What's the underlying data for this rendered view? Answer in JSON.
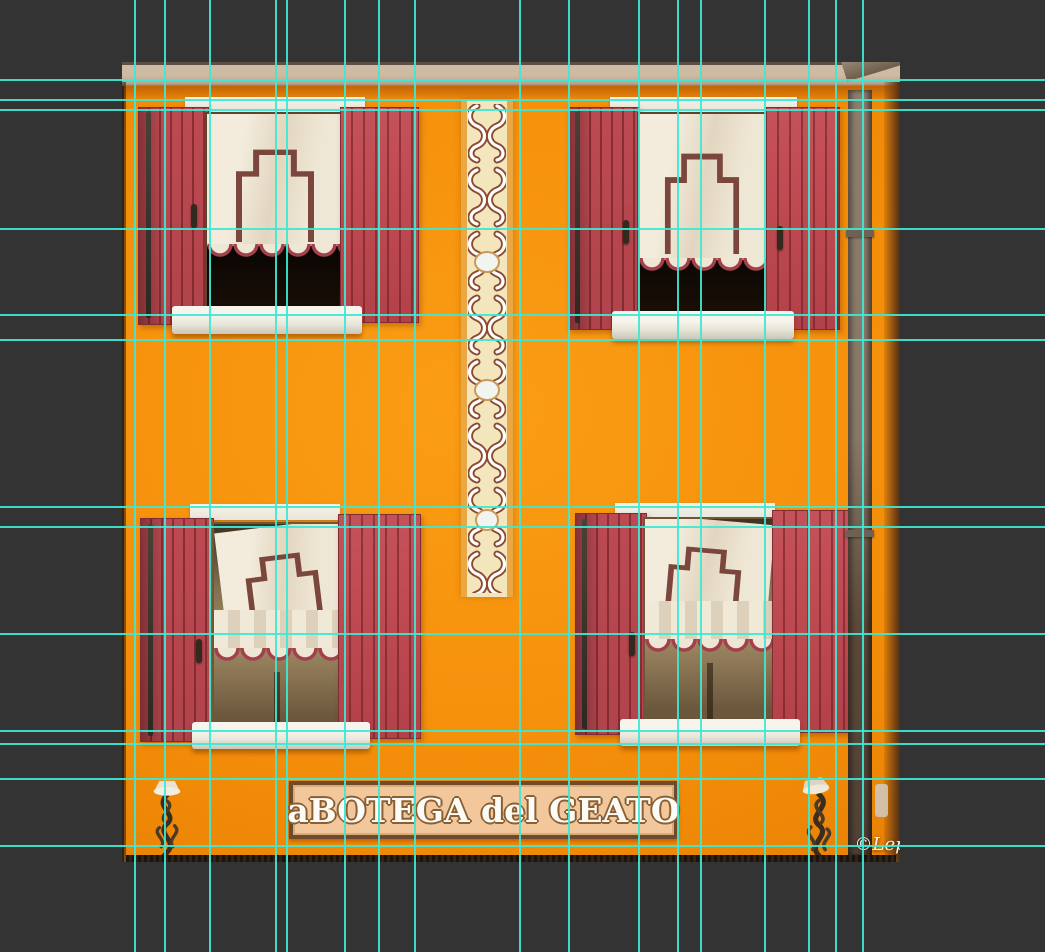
{
  "canvas": {
    "width": 1045,
    "height": 952
  },
  "colors": {
    "background": "#333333",
    "guide": "#3EE8D2",
    "facade": "#F7930E",
    "roof": "#CFBAA3",
    "shutter": "#BF4B52",
    "shutter_dark": "#8E3138",
    "lintel": "#EFEDE3",
    "sill": "#EDEBE0",
    "curtain": "#EFE7D5",
    "trim": "#A34049",
    "pattern_brown": "#7B463C",
    "interior_dark": "#0C0705",
    "glass": "#8A7356",
    "strip_bg": "#F4E6BC",
    "strip_border": "#E9A845",
    "strip_motif_outline": "#8A4A30",
    "sign_bg": "#F2C79C",
    "sign_border": "#6F4A2C",
    "sign_text": "#FCFBF5",
    "sign_text_outline": "#8A5F33",
    "pipe": "#8D7C6C",
    "pipe_dark": "#514034",
    "iron": "#3A2D20",
    "watermark": "#FFFFFF"
  },
  "guides": {
    "color": "#3EE8D2",
    "vertical": [
      135,
      165,
      210,
      276,
      287,
      345,
      379,
      415,
      520,
      569,
      639,
      678,
      701,
      765,
      809,
      836,
      863
    ],
    "horizontal": [
      80,
      100,
      110,
      229,
      315,
      340,
      507,
      527,
      634,
      731,
      744,
      779,
      846
    ]
  },
  "sign": {
    "text": "aBOTEGA del GEATO"
  },
  "watermark": {
    "text": "©Lepore Rosario"
  }
}
